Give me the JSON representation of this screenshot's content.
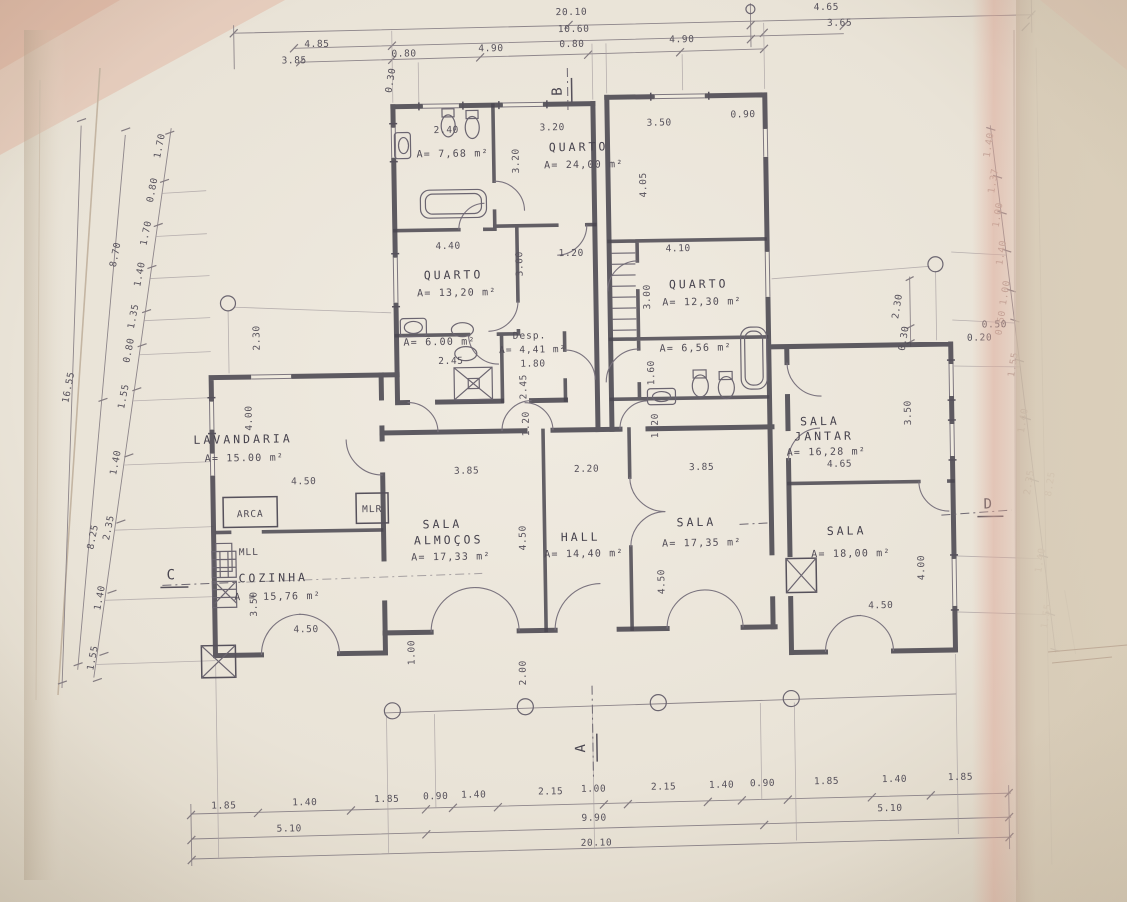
{
  "document": {
    "kind": "scanned architectural floor plan",
    "language": "Portuguese",
    "paper_color": "#e9e3d7",
    "ink_color": "#4a4750",
    "tint_color": "#dcae9e"
  },
  "rooms": [
    {
      "name": "QUARTO",
      "area": "A= 24,00 m²"
    },
    {
      "name": "QUARTO",
      "area": "A= 13,20 m²"
    },
    {
      "name": "QUARTO",
      "area": "A= 12,30 m²"
    },
    {
      "name": "LAVANDARIA",
      "area": "A= 15.00 m²"
    },
    {
      "name": "COZINHA",
      "area": "A = 15,76 m²"
    },
    {
      "name": "SALA ALMOÇOS",
      "area": "A= 17,33 m²"
    },
    {
      "name": "HALL",
      "area": "A= 14,40 m²"
    },
    {
      "name": "SALA",
      "area": "A= 17,35 m²"
    },
    {
      "name": "SALA JANTAR",
      "area": "A= 16,28 m²"
    },
    {
      "name": "SALA",
      "area": "A= 18,00 m²"
    },
    {
      "name": "Desp.",
      "area": "A= 4,41 m²"
    },
    {
      "name": "banho 1",
      "area": "A= 7,68 m²"
    },
    {
      "name": "banho 2",
      "area": "A= 6.00 m²"
    },
    {
      "name": "banho 3",
      "area": "A= 6,56 m²"
    }
  ],
  "section_markers": [
    "A",
    "B",
    "C",
    "D"
  ],
  "annotations": [
    {
      "t": "20.10",
      "x": 578,
      "y": 15,
      "n": "dim-top-total"
    },
    {
      "t": "10.60",
      "x": 580,
      "y": 32,
      "n": "dim-top-mid"
    },
    {
      "t": "4.65",
      "x": 833,
      "y": 14
    },
    {
      "t": "3.65",
      "x": 846,
      "y": 30
    },
    {
      "t": "4.85",
      "x": 323,
      "y": 43
    },
    {
      "t": "3.85",
      "x": 300,
      "y": 59
    },
    {
      "t": "0.80",
      "x": 410,
      "y": 54
    },
    {
      "t": "4.90",
      "x": 497,
      "y": 50
    },
    {
      "t": "0.80",
      "x": 578,
      "y": 47
    },
    {
      "t": "4.90",
      "x": 688,
      "y": 44
    },
    {
      "t": "0.30",
      "x": 399,
      "y": 78,
      "r": -80
    },
    {
      "t": "B",
      "x": 567,
      "y": 91,
      "r": -90,
      "c": "marker",
      "n": "section-marker-b"
    },
    {
      "t": "1.85",
      "x": 218,
      "y": 803
    },
    {
      "t": "1.40",
      "x": 299,
      "y": 801
    },
    {
      "t": "1.85",
      "x": 381,
      "y": 799
    },
    {
      "t": "0.90",
      "x": 430,
      "y": 797
    },
    {
      "t": "1.40",
      "x": 468,
      "y": 796
    },
    {
      "t": "2.15",
      "x": 545,
      "y": 794
    },
    {
      "t": "1.00",
      "x": 588,
      "y": 792
    },
    {
      "t": "2.15",
      "x": 658,
      "y": 791
    },
    {
      "t": "1.40",
      "x": 716,
      "y": 790
    },
    {
      "t": "0.90",
      "x": 757,
      "y": 789
    },
    {
      "t": "1.85",
      "x": 821,
      "y": 788
    },
    {
      "t": "1.40",
      "x": 889,
      "y": 787
    },
    {
      "t": "1.85",
      "x": 955,
      "y": 786
    },
    {
      "t": "5.10",
      "x": 283,
      "y": 827
    },
    {
      "t": "9.90",
      "x": 588,
      "y": 821
    },
    {
      "t": "5.10",
      "x": 884,
      "y": 816
    },
    {
      "t": "20.10",
      "x": 590,
      "y": 846,
      "n": "dim-bottom-total"
    },
    {
      "t": "A",
      "x": 580,
      "y": 748,
      "r": -90,
      "c": "marker",
      "n": "section-marker-a"
    },
    {
      "t": "16.55",
      "x": 72,
      "y": 380,
      "r": -78,
      "n": "dim-left-total"
    },
    {
      "t": "8.70",
      "x": 121,
      "y": 248,
      "r": -78
    },
    {
      "t": "8.25",
      "x": 94,
      "y": 530,
      "r": -78
    },
    {
      "t": "1.70",
      "x": 167,
      "y": 140,
      "r": -78
    },
    {
      "t": "0.80",
      "x": 159,
      "y": 184,
      "r": -78
    },
    {
      "t": "1.70",
      "x": 152,
      "y": 227,
      "r": -78
    },
    {
      "t": "1.40",
      "x": 145,
      "y": 268,
      "r": -78
    },
    {
      "t": "1.35",
      "x": 138,
      "y": 310,
      "r": -78
    },
    {
      "t": "0.80",
      "x": 133,
      "y": 344,
      "r": -78
    },
    {
      "t": "1.55",
      "x": 127,
      "y": 390,
      "r": -78
    },
    {
      "t": "1.40",
      "x": 118,
      "y": 456,
      "r": -78
    },
    {
      "t": "2.35",
      "x": 110,
      "y": 521,
      "r": -78
    },
    {
      "t": "1.40",
      "x": 100,
      "y": 591,
      "r": -78
    },
    {
      "t": "1.55",
      "x": 92,
      "y": 651,
      "r": -78
    },
    {
      "t": "C",
      "x": 169,
      "y": 573,
      "c": "marker",
      "n": "section-marker-c"
    },
    {
      "t": "1.40",
      "x": 996,
      "y": 152,
      "r": -80,
      "c": "dimfaint"
    },
    {
      "t": "1.37",
      "x": 1000,
      "y": 188,
      "r": -80,
      "c": "dimfaint"
    },
    {
      "t": "1.00",
      "x": 1004,
      "y": 222,
      "r": -80,
      "c": "dimfaint"
    },
    {
      "t": "1.40",
      "x": 1007,
      "y": 260,
      "r": -80,
      "c": "dimfaint"
    },
    {
      "t": "1.00",
      "x": 1010,
      "y": 300,
      "r": -80,
      "c": "dimfaint"
    },
    {
      "t": "0.50",
      "x": 1005,
      "y": 330,
      "r": -80,
      "c": "dimfaint"
    },
    {
      "t": "1.55",
      "x": 1017,
      "y": 372,
      "r": -80,
      "c": "dimfaint"
    },
    {
      "t": "1.40",
      "x": 1026,
      "y": 428,
      "r": -80,
      "c": "dimfaint"
    },
    {
      "t": "2.35",
      "x": 1031,
      "y": 490,
      "r": -80,
      "c": "dimfaint"
    },
    {
      "t": "8.25",
      "x": 1052,
      "y": 492,
      "r": -80,
      "c": "dimfaint"
    },
    {
      "t": "1.40",
      "x": 1041,
      "y": 568,
      "r": -80,
      "c": "dimfaint"
    },
    {
      "t": "1.55",
      "x": 1046,
      "y": 624,
      "r": -80,
      "c": "dimfaint"
    },
    {
      "t": "2.30",
      "x": 902,
      "y": 312,
      "r": -80
    },
    {
      "t": "0.30",
      "x": 908,
      "y": 344,
      "r": -80
    },
    {
      "t": "0.50",
      "x": 996,
      "y": 334
    },
    {
      "t": "0.20",
      "x": 981,
      "y": 347
    },
    {
      "t": "D",
      "x": 987,
      "y": 515,
      "c": "marker",
      "n": "section-marker-d"
    },
    {
      "t": "QUARTO",
      "x": 583,
      "y": 151,
      "c": "room",
      "n": "room-label-quarto-1"
    },
    {
      "t": "A= 24,00 m²",
      "x": 588,
      "y": 168,
      "c": "area",
      "n": "room-area-quarto-1"
    },
    {
      "t": "QUARTO",
      "x": 456,
      "y": 277,
      "c": "room",
      "n": "room-label-quarto-2"
    },
    {
      "t": "A= 13,20 m²",
      "x": 459,
      "y": 294,
      "c": "area",
      "n": "room-area-quarto-2"
    },
    {
      "t": "QUARTO",
      "x": 701,
      "y": 290,
      "c": "room",
      "n": "room-label-quarto-3"
    },
    {
      "t": "A= 12,30 m²",
      "x": 704,
      "y": 307,
      "c": "area",
      "n": "room-area-quarto-3"
    },
    {
      "t": "LAVANDARIA",
      "x": 243,
      "y": 438,
      "c": "room",
      "n": "room-label-lavandaria"
    },
    {
      "t": "A= 15.00 m²",
      "x": 244,
      "y": 456,
      "c": "area",
      "n": "room-area-lavandaria"
    },
    {
      "t": "COZINHA",
      "x": 271,
      "y": 577,
      "c": "room",
      "n": "room-label-cozinha"
    },
    {
      "t": "A = 15,76 m²",
      "x": 275,
      "y": 595,
      "c": "area",
      "n": "room-area-cozinha"
    },
    {
      "t": "SALA",
      "x": 441,
      "y": 526,
      "c": "room",
      "n": "room-label-sala-almocos"
    },
    {
      "t": "ALMOÇOS",
      "x": 447,
      "y": 542,
      "c": "room"
    },
    {
      "t": "A= 17,33 m²",
      "x": 449,
      "y": 558,
      "c": "area",
      "n": "room-area-sala-almocos"
    },
    {
      "t": "HALL",
      "x": 579,
      "y": 541,
      "c": "room",
      "n": "room-label-hall"
    },
    {
      "t": "A= 14,40 m²",
      "x": 582,
      "y": 557,
      "c": "area",
      "n": "room-area-hall"
    },
    {
      "t": "SALA",
      "x": 695,
      "y": 528,
      "c": "room",
      "n": "room-label-sala"
    },
    {
      "t": "A= 17,35 m²",
      "x": 700,
      "y": 548,
      "c": "area",
      "n": "room-area-sala"
    },
    {
      "t": "SALA",
      "x": 820,
      "y": 429,
      "c": "room",
      "n": "room-label-sala-jantar"
    },
    {
      "t": "JANTAR",
      "x": 824,
      "y": 444,
      "c": "room"
    },
    {
      "t": "A= 16,28 m²",
      "x": 826,
      "y": 459,
      "c": "area",
      "n": "room-area-sala-jantar"
    },
    {
      "t": "SALA",
      "x": 845,
      "y": 539,
      "c": "room",
      "n": "room-label-sala-2"
    },
    {
      "t": "A= 18,00 m²",
      "x": 849,
      "y": 561,
      "c": "area",
      "n": "room-area-sala-2"
    },
    {
      "t": "Desp.",
      "x": 531,
      "y": 338,
      "c": "small",
      "n": "room-label-despensa"
    },
    {
      "t": "A= 4,41 m²",
      "x": 534,
      "y": 352,
      "c": "small",
      "n": "room-area-despensa"
    },
    {
      "t": "A= 7,68 m²",
      "x": 457,
      "y": 155,
      "c": "area",
      "n": "room-area-banho-1"
    },
    {
      "t": "A= 6.00 m²",
      "x": 441,
      "y": 343,
      "c": "area",
      "n": "room-area-banho-2"
    },
    {
      "t": "A= 6,56 m²",
      "x": 697,
      "y": 353,
      "c": "area",
      "n": "room-area-banho-3"
    },
    {
      "t": "ARCA",
      "x": 249,
      "y": 512,
      "c": "small",
      "n": "fixture-label-arca"
    },
    {
      "t": "MLR",
      "x": 371,
      "y": 509,
      "c": "small",
      "n": "fixture-label-mlr"
    },
    {
      "t": "MLL",
      "x": 247,
      "y": 550,
      "c": "small",
      "n": "fixture-label-mll"
    },
    {
      "t": "2.40",
      "x": 451,
      "y": 131
    },
    {
      "t": "3.20",
      "x": 557,
      "y": 130
    },
    {
      "t": "3.20",
      "x": 523,
      "y": 160,
      "r": -90
    },
    {
      "t": "3.50",
      "x": 664,
      "y": 127
    },
    {
      "t": "0.90",
      "x": 748,
      "y": 120
    },
    {
      "t": "4.05",
      "x": 650,
      "y": 186,
      "r": -90
    },
    {
      "t": "4.40",
      "x": 451,
      "y": 247
    },
    {
      "t": "3.00",
      "x": 525,
      "y": 263,
      "r": -90
    },
    {
      "t": "1.20",
      "x": 574,
      "y": 256
    },
    {
      "t": "4.10",
      "x": 681,
      "y": 253
    },
    {
      "t": "3.00",
      "x": 652,
      "y": 298,
      "r": -90
    },
    {
      "t": "2.45",
      "x": 452,
      "y": 362
    },
    {
      "t": "1.80",
      "x": 534,
      "y": 366
    },
    {
      "t": "2.45",
      "x": 527,
      "y": 386,
      "r": -90
    },
    {
      "t": "1.60",
      "x": 655,
      "y": 374,
      "r": -90
    },
    {
      "t": "4.00",
      "x": 252,
      "y": 413,
      "r": -90
    },
    {
      "t": "2.30",
      "x": 261,
      "y": 333,
      "r": -90
    },
    {
      "t": "4.50",
      "x": 303,
      "y": 480
    },
    {
      "t": "3.50",
      "x": 254,
      "y": 599,
      "r": -90
    },
    {
      "t": "4.50",
      "x": 303,
      "y": 628
    },
    {
      "t": "3.85",
      "x": 466,
      "y": 472
    },
    {
      "t": "4.50",
      "x": 524,
      "y": 537,
      "r": -90
    },
    {
      "t": "2.20",
      "x": 586,
      "y": 472
    },
    {
      "t": "3.85",
      "x": 701,
      "y": 472
    },
    {
      "t": "4.50",
      "x": 662,
      "y": 583,
      "r": -90
    },
    {
      "t": "1.20",
      "x": 529,
      "y": 423,
      "r": -90
    },
    {
      "t": "1.20",
      "x": 658,
      "y": 427,
      "r": -90
    },
    {
      "t": "4.65",
      "x": 839,
      "y": 471
    },
    {
      "t": "3.50",
      "x": 911,
      "y": 418,
      "r": -90
    },
    {
      "t": "4.00",
      "x": 922,
      "y": 573,
      "r": -90
    },
    {
      "t": "4.50",
      "x": 878,
      "y": 613
    },
    {
      "t": "1.00",
      "x": 411,
      "y": 650,
      "r": -90
    },
    {
      "t": "2.00",
      "x": 522,
      "y": 672,
      "r": -90
    }
  ]
}
